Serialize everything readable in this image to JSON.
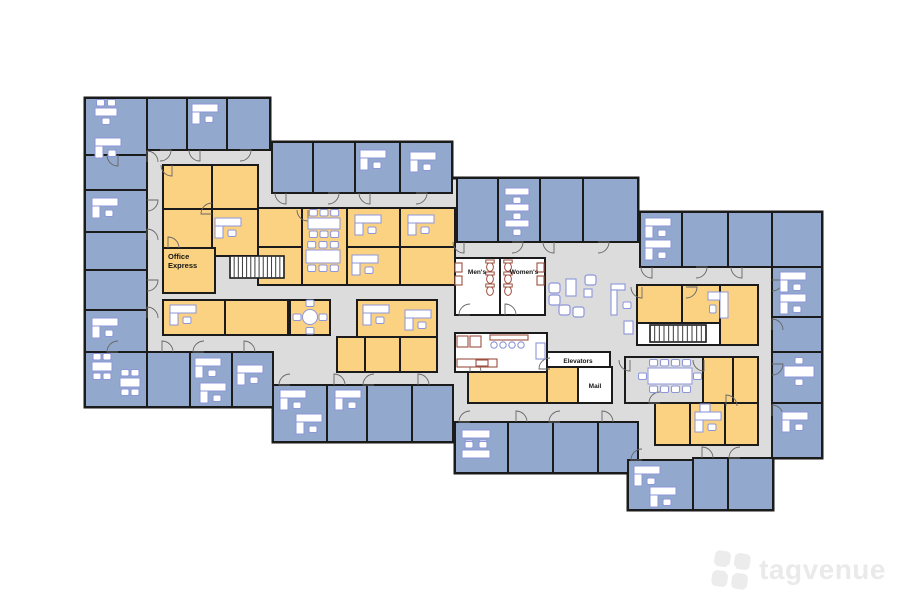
{
  "watermark": {
    "text": "tagvenue",
    "color": "#ececec"
  },
  "palette": {
    "background": "#ffffff",
    "corridor_gray": "#dcdcdc",
    "office_blue": "#92a8cc",
    "interior_yellow": "#fbd282",
    "service_white": "#ffffff",
    "wall_black": "#1b1b1b",
    "furniture_blue": "#8d96d8",
    "fixture_brown": "#9c4f3f",
    "door_gray": "#666666",
    "label_black": "#151515"
  },
  "floorplan": {
    "width": 900,
    "height": 600,
    "outline": "85,98 270,98 270,142 452,142 452,178 638,178 638,212 822,212 822,458 773,458 773,510 628,510 628,473 455,473 455,442 273,442 273,407 85,407",
    "room_types": {
      "b": "office-room",
      "y": "interior-office",
      "s": "service-room",
      "g": "meeting-room"
    },
    "rooms": [
      [
        85,
        98,
        62,
        57,
        "b"
      ],
      [
        147,
        98,
        40,
        52,
        "b"
      ],
      [
        187,
        98,
        40,
        52,
        "b"
      ],
      [
        227,
        98,
        43,
        52,
        "b"
      ],
      [
        272,
        142,
        41,
        51,
        "b"
      ],
      [
        313,
        142,
        42,
        51,
        "b"
      ],
      [
        355,
        142,
        45,
        51,
        "b"
      ],
      [
        400,
        142,
        52,
        51,
        "b"
      ],
      [
        85,
        155,
        62,
        35,
        "b"
      ],
      [
        85,
        190,
        62,
        42,
        "b"
      ],
      [
        85,
        232,
        62,
        38,
        "b"
      ],
      [
        85,
        270,
        62,
        40,
        "b"
      ],
      [
        85,
        310,
        62,
        42,
        "b"
      ],
      [
        85,
        352,
        62,
        55,
        "b"
      ],
      [
        147,
        352,
        43,
        55,
        "b"
      ],
      [
        190,
        352,
        42,
        55,
        "b"
      ],
      [
        232,
        352,
        41,
        55,
        "b"
      ],
      [
        273,
        385,
        54,
        57,
        "b"
      ],
      [
        327,
        385,
        40,
        57,
        "b"
      ],
      [
        367,
        385,
        45,
        57,
        "b"
      ],
      [
        412,
        385,
        41,
        57,
        "b"
      ],
      [
        163,
        165,
        49,
        44,
        "y"
      ],
      [
        212,
        165,
        46,
        44,
        "y"
      ],
      [
        163,
        209,
        49,
        39,
        "y"
      ],
      [
        212,
        209,
        46,
        47,
        "y"
      ],
      [
        163,
        248,
        52,
        45,
        "y"
      ],
      [
        258,
        208,
        44,
        39,
        "y"
      ],
      [
        302,
        208,
        45,
        77,
        "y"
      ],
      [
        347,
        208,
        53,
        39,
        "y"
      ],
      [
        400,
        208,
        55,
        39,
        "y"
      ],
      [
        258,
        247,
        44,
        38,
        "y"
      ],
      [
        347,
        247,
        53,
        38,
        "y"
      ],
      [
        400,
        247,
        55,
        38,
        "y"
      ],
      [
        163,
        300,
        62,
        35,
        "y"
      ],
      [
        225,
        300,
        63,
        35,
        "y"
      ],
      [
        290,
        300,
        40,
        35,
        "y"
      ],
      [
        357,
        300,
        80,
        37,
        "y"
      ],
      [
        337,
        337,
        28,
        35,
        "y"
      ],
      [
        365,
        337,
        35,
        35,
        "y"
      ],
      [
        400,
        337,
        37,
        35,
        "y"
      ],
      [
        457,
        178,
        41,
        64,
        "b"
      ],
      [
        498,
        178,
        42,
        64,
        "b"
      ],
      [
        540,
        178,
        43,
        64,
        "b"
      ],
      [
        583,
        178,
        55,
        64,
        "b"
      ],
      [
        455,
        258,
        45,
        57,
        "s"
      ],
      [
        500,
        258,
        45,
        57,
        "s"
      ],
      [
        455,
        333,
        92,
        39,
        "s"
      ],
      [
        547,
        352,
        63,
        15,
        "s"
      ],
      [
        578,
        367,
        34,
        36,
        "s"
      ],
      [
        468,
        372,
        79,
        31,
        "y"
      ],
      [
        547,
        367,
        31,
        36,
        "y"
      ],
      [
        455,
        422,
        53,
        51,
        "b"
      ],
      [
        508,
        422,
        45,
        51,
        "b"
      ],
      [
        553,
        422,
        45,
        51,
        "b"
      ],
      [
        598,
        422,
        40,
        51,
        "b"
      ],
      [
        640,
        212,
        42,
        55,
        "b"
      ],
      [
        682,
        212,
        46,
        55,
        "b"
      ],
      [
        728,
        212,
        44,
        55,
        "b"
      ],
      [
        772,
        212,
        50,
        55,
        "b"
      ],
      [
        772,
        267,
        50,
        50,
        "b"
      ],
      [
        772,
        317,
        50,
        35,
        "b"
      ],
      [
        772,
        352,
        50,
        51,
        "b"
      ],
      [
        772,
        403,
        50,
        55,
        "b"
      ],
      [
        637,
        285,
        45,
        38,
        "y"
      ],
      [
        682,
        285,
        38,
        38,
        "y"
      ],
      [
        720,
        285,
        38,
        60,
        "y"
      ],
      [
        637,
        323,
        83,
        22,
        "s"
      ],
      [
        625,
        357,
        78,
        46,
        "g"
      ],
      [
        703,
        357,
        30,
        46,
        "y"
      ],
      [
        733,
        357,
        25,
        46,
        "y"
      ],
      [
        655,
        403,
        35,
        42,
        "y"
      ],
      [
        690,
        403,
        35,
        42,
        "y"
      ],
      [
        725,
        403,
        33,
        42,
        "y"
      ],
      [
        628,
        460,
        65,
        50,
        "b"
      ],
      [
        693,
        458,
        35,
        52,
        "b"
      ],
      [
        728,
        458,
        45,
        52,
        "b"
      ]
    ],
    "stairs": [
      [
        230,
        256,
        54,
        22,
        13
      ],
      [
        650,
        325,
        56,
        17,
        12
      ]
    ],
    "doors": [
      [
        118,
        155,
        1
      ],
      [
        160,
        150,
        0
      ],
      [
        200,
        150,
        1
      ],
      [
        240,
        150,
        0
      ],
      [
        286,
        193,
        1
      ],
      [
        328,
        193,
        0
      ],
      [
        370,
        193,
        1
      ],
      [
        416,
        193,
        0
      ],
      [
        147,
        162,
        3
      ],
      [
        147,
        200,
        0
      ],
      [
        147,
        240,
        3
      ],
      [
        147,
        280,
        0
      ],
      [
        147,
        318,
        3
      ],
      [
        118,
        352,
        2
      ],
      [
        162,
        352,
        3
      ],
      [
        204,
        352,
        2
      ],
      [
        244,
        352,
        3
      ],
      [
        290,
        385,
        2
      ],
      [
        334,
        385,
        3
      ],
      [
        374,
        385,
        2
      ],
      [
        418,
        385,
        3
      ],
      [
        464,
        242,
        1
      ],
      [
        512,
        242,
        0
      ],
      [
        554,
        242,
        1
      ],
      [
        598,
        242,
        0
      ],
      [
        470,
        422,
        2
      ],
      [
        516,
        422,
        3
      ],
      [
        560,
        422,
        2
      ],
      [
        602,
        422,
        3
      ],
      [
        652,
        267,
        1
      ],
      [
        696,
        267,
        0
      ],
      [
        742,
        267,
        1
      ],
      [
        772,
        280,
        0
      ],
      [
        772,
        330,
        3
      ],
      [
        772,
        364,
        0
      ],
      [
        772,
        416,
        3
      ],
      [
        642,
        460,
        2
      ],
      [
        702,
        458,
        3
      ],
      [
        740,
        458,
        2
      ],
      [
        172,
        165,
        1
      ],
      [
        212,
        214,
        2
      ],
      [
        168,
        248,
        3
      ],
      [
        308,
        210,
        1
      ],
      [
        470,
        372,
        3
      ],
      [
        550,
        369,
        2
      ],
      [
        642,
        287,
        1
      ],
      [
        686,
        287,
        0
      ],
      [
        660,
        403,
        2
      ],
      [
        726,
        406,
        3
      ],
      [
        704,
        360,
        1
      ],
      [
        470,
        315,
        2
      ],
      [
        505,
        315,
        3
      ],
      [
        630,
        360,
        1
      ]
    ],
    "desks": [
      [
        95,
        138
      ],
      [
        192,
        104
      ],
      [
        360,
        150
      ],
      [
        410,
        152
      ],
      [
        92,
        198
      ],
      [
        92,
        318
      ],
      [
        195,
        358
      ],
      [
        200,
        383
      ],
      [
        237,
        365
      ],
      [
        280,
        390
      ],
      [
        296,
        414
      ],
      [
        335,
        390
      ],
      [
        215,
        218
      ],
      [
        355,
        215
      ],
      [
        408,
        215
      ],
      [
        352,
        255
      ],
      [
        170,
        305
      ],
      [
        363,
        305
      ],
      [
        405,
        310
      ],
      [
        728,
        292,
        90
      ],
      [
        695,
        412
      ],
      [
        780,
        272
      ],
      [
        780,
        294
      ],
      [
        782,
        412
      ],
      [
        634,
        466
      ],
      [
        650,
        487
      ],
      [
        645,
        218
      ],
      [
        645,
        240
      ]
    ],
    "tables": [
      [
        95,
        108,
        22,
        8,
        2,
        1
      ],
      [
        92,
        362,
        20,
        9,
        2,
        2
      ],
      [
        120,
        378,
        20,
        9,
        2,
        2
      ],
      [
        505,
        188,
        24,
        7,
        0,
        1
      ],
      [
        505,
        204,
        24,
        7,
        0,
        1
      ],
      [
        505,
        220,
        24,
        7,
        0,
        1
      ],
      [
        462,
        430,
        28,
        8,
        0,
        2
      ],
      [
        462,
        450,
        28,
        8,
        2,
        0
      ],
      [
        308,
        218,
        32,
        11,
        3,
        3
      ],
      [
        306,
        250,
        34,
        13,
        3,
        3
      ],
      [
        648,
        368,
        44,
        16,
        4,
        4,
        1,
        1
      ],
      [
        784,
        366,
        30,
        11,
        1,
        1
      ]
    ],
    "round_tables": [
      [
        310,
        317
      ]
    ],
    "lounge_seats": [
      [
        549,
        283
      ],
      [
        549,
        295
      ],
      [
        585,
        275
      ],
      [
        559,
        305
      ],
      [
        573,
        307
      ]
    ],
    "side_chairs": [
      [
        623,
        302
      ]
    ],
    "blue_fixtures": [
      [
        566,
        279,
        10,
        17
      ],
      [
        584,
        289,
        8,
        8
      ],
      [
        611,
        284,
        14,
        6
      ],
      [
        611,
        290,
        6,
        25
      ],
      [
        624,
        321,
        9,
        13
      ],
      [
        536,
        343,
        9,
        16
      ],
      [
        700,
        404,
        10,
        8
      ]
    ],
    "brown_fixtures": [
      [
        457,
        336,
        11,
        11
      ],
      [
        470,
        336,
        11,
        11
      ],
      [
        490,
        335,
        38,
        5
      ],
      [
        457,
        359,
        40,
        8
      ],
      [
        476,
        360,
        12,
        6
      ],
      [
        455,
        263,
        7,
        9
      ],
      [
        455,
        276,
        7,
        9
      ],
      [
        537,
        263,
        7,
        9
      ],
      [
        537,
        276,
        7,
        9
      ]
    ],
    "stools": [
      [
        494,
        345
      ],
      [
        503,
        345
      ],
      [
        512,
        345
      ],
      [
        521,
        345
      ]
    ],
    "toilets": [
      [
        490,
        267
      ],
      [
        490,
        279
      ],
      [
        490,
        291
      ],
      [
        508,
        267
      ],
      [
        508,
        279
      ],
      [
        508,
        291
      ]
    ],
    "labels": [
      {
        "lines": [
          "Office",
          "Express"
        ],
        "x": 168,
        "y": 259,
        "size": 7.5,
        "anchor": "start",
        "name": "office-express-label"
      },
      {
        "lines": [
          "Men's"
        ],
        "x": 477,
        "y": 274,
        "size": 6.5,
        "anchor": "middle",
        "name": "mens-room-label"
      },
      {
        "lines": [
          "Women's"
        ],
        "x": 524,
        "y": 274,
        "size": 6.5,
        "anchor": "middle",
        "name": "womens-room-label"
      },
      {
        "lines": [
          "Elevators"
        ],
        "x": 578,
        "y": 363,
        "size": 6.5,
        "anchor": "middle",
        "name": "elevators-label"
      },
      {
        "lines": [
          "Mail"
        ],
        "x": 595,
        "y": 388,
        "size": 6.5,
        "anchor": "middle",
        "name": "mail-room-label"
      }
    ]
  }
}
